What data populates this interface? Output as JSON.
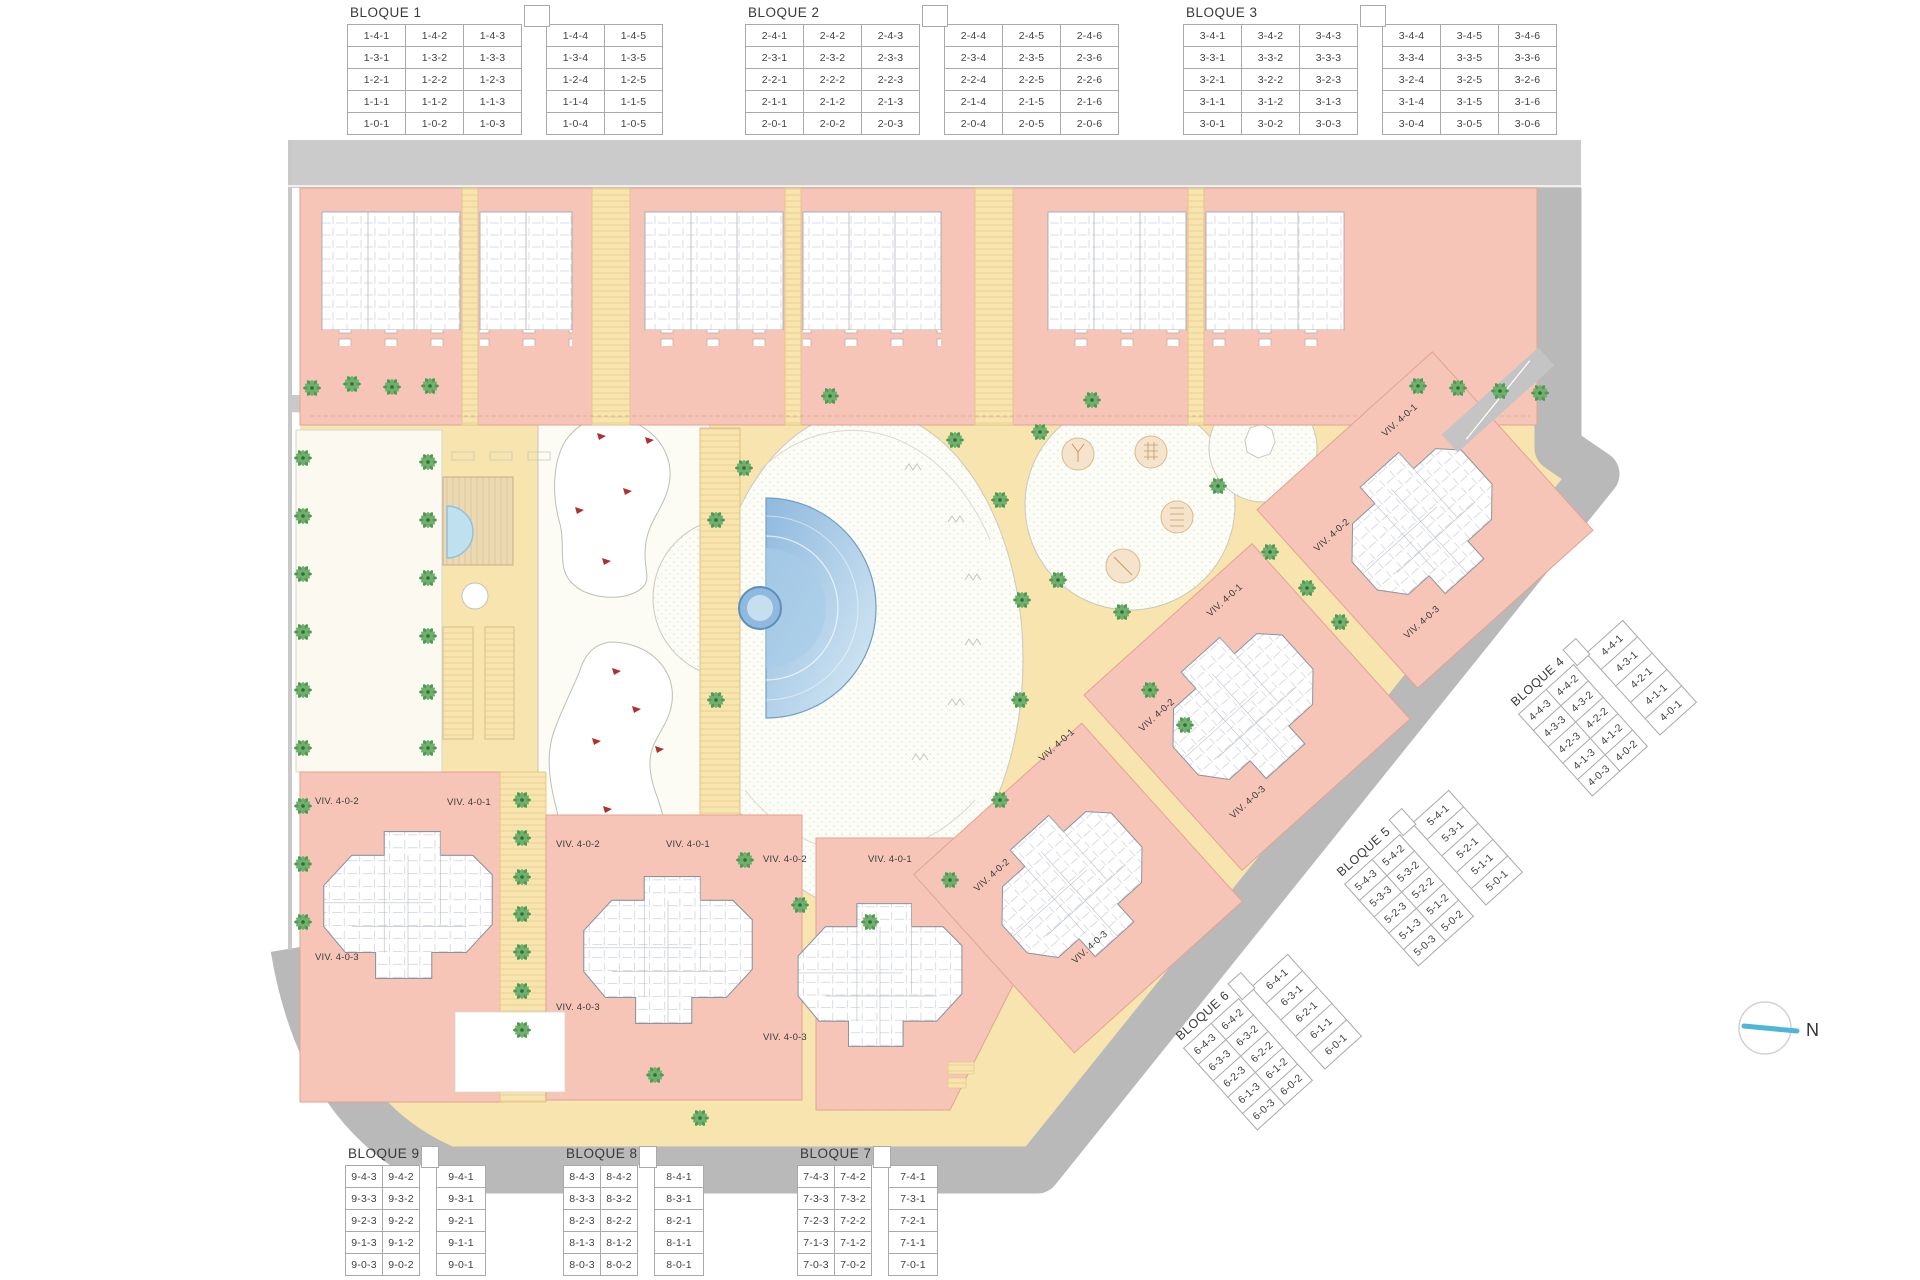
{
  "north": {
    "label": "N"
  },
  "viv_labels": {
    "v1": "VIV. 4-0-1",
    "v2": "VIV. 4-0-2",
    "v3": "VIV. 4-0-3"
  },
  "blocks": [
    {
      "name": "BLOQUE 1",
      "gap_after": 3,
      "rows": [
        [
          "1-4-1",
          "1-4-2",
          "1-4-3",
          "1-4-4",
          "1-4-5"
        ],
        [
          "1-3-1",
          "1-3-2",
          "1-3-3",
          "1-3-4",
          "1-3-5"
        ],
        [
          "1-2-1",
          "1-2-2",
          "1-2-3",
          "1-2-4",
          "1-2-5"
        ],
        [
          "1-1-1",
          "1-1-2",
          "1-1-3",
          "1-1-4",
          "1-1-5"
        ],
        [
          "1-0-1",
          "1-0-2",
          "1-0-3",
          "1-0-4",
          "1-0-5"
        ]
      ]
    },
    {
      "name": "BLOQUE 2",
      "gap_after": 3,
      "rows": [
        [
          "2-4-1",
          "2-4-2",
          "2-4-3",
          "2-4-4",
          "2-4-5",
          "2-4-6"
        ],
        [
          "2-3-1",
          "2-3-2",
          "2-3-3",
          "2-3-4",
          "2-3-5",
          "2-3-6"
        ],
        [
          "2-2-1",
          "2-2-2",
          "2-2-3",
          "2-2-4",
          "2-2-5",
          "2-2-6"
        ],
        [
          "2-1-1",
          "2-1-2",
          "2-1-3",
          "2-1-4",
          "2-1-5",
          "2-1-6"
        ],
        [
          "2-0-1",
          "2-0-2",
          "2-0-3",
          "2-0-4",
          "2-0-5",
          "2-0-6"
        ]
      ]
    },
    {
      "name": "BLOQUE 3",
      "gap_after": 3,
      "rows": [
        [
          "3-4-1",
          "3-4-2",
          "3-4-3",
          "3-4-4",
          "3-4-5",
          "3-4-6"
        ],
        [
          "3-3-1",
          "3-3-2",
          "3-3-3",
          "3-3-4",
          "3-3-5",
          "3-3-6"
        ],
        [
          "3-2-1",
          "3-2-2",
          "3-2-3",
          "3-2-4",
          "3-2-5",
          "3-2-6"
        ],
        [
          "3-1-1",
          "3-1-2",
          "3-1-3",
          "3-1-4",
          "3-1-5",
          "3-1-6"
        ],
        [
          "3-0-1",
          "3-0-2",
          "3-0-3",
          "3-0-4",
          "3-0-5",
          "3-0-6"
        ]
      ]
    },
    {
      "name": "BLOQUE 4",
      "gap_after": 2,
      "rows": [
        [
          "4-4-3",
          "4-4-2",
          "4-4-1"
        ],
        [
          "4-3-3",
          "4-3-2",
          "4-3-1"
        ],
        [
          "4-2-3",
          "4-2-2",
          "4-2-1"
        ],
        [
          "4-1-3",
          "4-1-2",
          "4-1-1"
        ],
        [
          "4-0-3",
          "4-0-2",
          "4-0-1"
        ]
      ]
    },
    {
      "name": "BLOQUE 5",
      "gap_after": 2,
      "rows": [
        [
          "5-4-3",
          "5-4-2",
          "5-4-1"
        ],
        [
          "5-3-3",
          "5-3-2",
          "5-3-1"
        ],
        [
          "5-2-3",
          "5-2-2",
          "5-2-1"
        ],
        [
          "5-1-3",
          "5-1-2",
          "5-1-1"
        ],
        [
          "5-0-3",
          "5-0-2",
          "5-0-1"
        ]
      ]
    },
    {
      "name": "BLOQUE 6",
      "gap_after": 2,
      "rows": [
        [
          "6-4-3",
          "6-4-2",
          "6-4-1"
        ],
        [
          "6-3-3",
          "6-3-2",
          "6-3-1"
        ],
        [
          "6-2-3",
          "6-2-2",
          "6-2-1"
        ],
        [
          "6-1-3",
          "6-1-2",
          "6-1-1"
        ],
        [
          "6-0-3",
          "6-0-2",
          "6-0-1"
        ]
      ]
    },
    {
      "name": "BLOQUE 7",
      "gap_after": 2,
      "rows": [
        [
          "7-4-3",
          "7-4-2",
          "7-4-1"
        ],
        [
          "7-3-3",
          "7-3-2",
          "7-3-1"
        ],
        [
          "7-2-3",
          "7-2-2",
          "7-2-1"
        ],
        [
          "7-1-3",
          "7-1-2",
          "7-1-1"
        ],
        [
          "7-0-3",
          "7-0-2",
          "7-0-1"
        ]
      ]
    },
    {
      "name": "BLOQUE 8",
      "gap_after": 2,
      "rows": [
        [
          "8-4-3",
          "8-4-2",
          "8-4-1"
        ],
        [
          "8-3-3",
          "8-3-2",
          "8-3-1"
        ],
        [
          "8-2-3",
          "8-2-2",
          "8-2-1"
        ],
        [
          "8-1-3",
          "8-1-2",
          "8-1-1"
        ],
        [
          "8-0-3",
          "8-0-2",
          "8-0-1"
        ]
      ]
    },
    {
      "name": "BLOQUE 9",
      "gap_after": 2,
      "rows": [
        [
          "9-4-3",
          "9-4-2",
          "9-4-1"
        ],
        [
          "9-3-3",
          "9-3-2",
          "9-3-1"
        ],
        [
          "9-2-3",
          "9-2-2",
          "9-2-1"
        ],
        [
          "9-1-3",
          "9-1-2",
          "9-1-1"
        ],
        [
          "9-0-3",
          "9-0-2",
          "9-0-1"
        ]
      ]
    }
  ],
  "colors": {
    "building_salmon": "#f6c5b8",
    "building_border": "#e2a392",
    "path_yellow": "#f8e4ae",
    "path_border": "#e0c27f",
    "road_gray": "#b9b9b9",
    "road_top_gray": "#cbcbcb",
    "plaza_white": "#fdfdf7",
    "pool_blue_dark": "#8fb9de",
    "pool_blue_light": "#d8eaf5",
    "palm_green": "#4f9b55",
    "pond_mark_red": "#b03030",
    "north_needle_blue": "#4fb6d8"
  }
}
